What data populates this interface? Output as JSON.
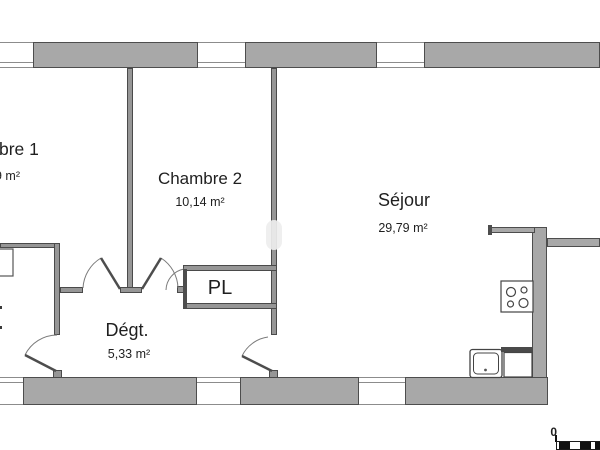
{
  "floor_plan": {
    "rooms": [
      {
        "name": "chambre-1",
        "label": "bre 1",
        "area": "9 m²"
      },
      {
        "name": "chambre-2",
        "label": "Chambre 2",
        "area": "10,14 m²"
      },
      {
        "name": "sejour",
        "label": "Séjour",
        "area": "29,79 m²"
      },
      {
        "name": "degagement",
        "label": "Dégt.",
        "area": "5,33 m²"
      },
      {
        "name": "placard",
        "label": "PL"
      }
    ],
    "scale_bar": {
      "zero_label": "0"
    },
    "fixtures": [
      "cooktop-icon",
      "sink-icon",
      "dishwasher-icon",
      "washbasin-icon"
    ],
    "colors": {
      "wall_fill": "#a8a8a8",
      "wall_stroke": "#4d4d4d",
      "interior_wall_fill": "#969696",
      "window_line": "#8c8c8c",
      "text": "#1f1f1f",
      "background": "#ffffff"
    }
  }
}
